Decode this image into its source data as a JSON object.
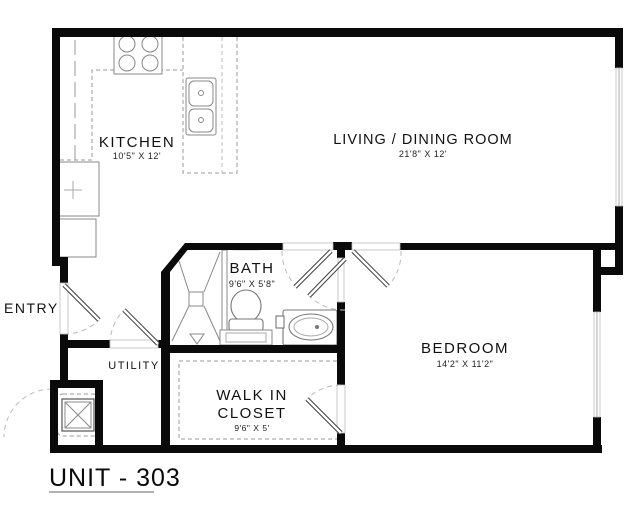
{
  "title": "UNIT - 303",
  "rooms": {
    "kitchen": {
      "name": "KITCHEN",
      "dims": "10'5\" X 12'"
    },
    "living_dining": {
      "name": "LIVING / DINING ROOM",
      "dims": "21'8\" X 12'"
    },
    "bath": {
      "name": "BATH",
      "dims": "9'6\" X 5'8\""
    },
    "bedroom": {
      "name": "BEDROOM",
      "dims": "14'2\" X 11'2\""
    },
    "entry": {
      "name": "ENTRY"
    },
    "utility": {
      "name": "UTILITY"
    },
    "walk_in_closet": {
      "line1": "WALK IN",
      "line2": "CLOSET",
      "dims": "9'6\" X 5'"
    }
  },
  "fixtures": [
    "stove",
    "kitchen-sink",
    "refrigerator",
    "pantry-cabinet",
    "shower",
    "toilet",
    "vanity-sink",
    "bathtub",
    "water-heater"
  ],
  "colors": {
    "walls": "#0a0a0a",
    "fixture_lines": "#888888",
    "dashed_lines": "#999999",
    "door_arcs": "#bbbbbb",
    "text": "#111111",
    "background": "#ffffff"
  }
}
